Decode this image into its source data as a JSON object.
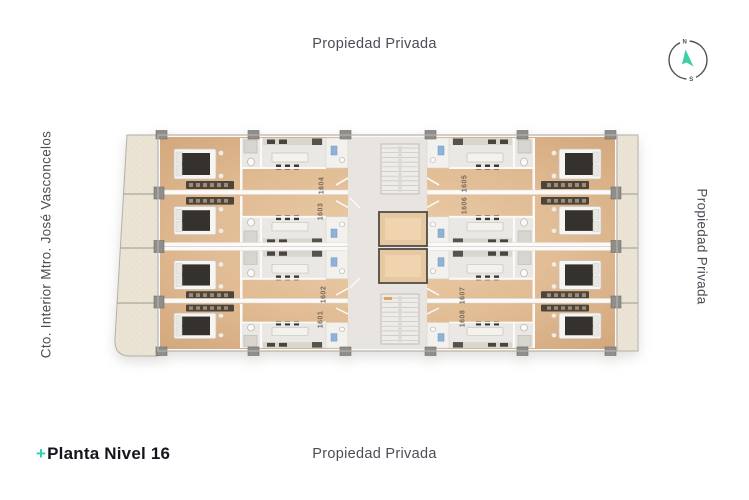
{
  "labels": {
    "top": "Propiedad Privada",
    "bottom": "Propiedad Privada",
    "right": "Propiedad Privada",
    "left": "Cto. Interior Mtro. José Vasconcelos"
  },
  "compass": {
    "north": "N",
    "south": "S",
    "needle_color": "#3ecfa5"
  },
  "footer": {
    "plus": "+",
    "title": "Planta Nivel 16",
    "accent_color": "#2fd0ad"
  },
  "plan": {
    "level": "16",
    "units": [
      {
        "label": "1601"
      },
      {
        "label": "1602"
      },
      {
        "label": "1603"
      },
      {
        "label": "1604"
      },
      {
        "label": "1605"
      },
      {
        "label": "1606"
      },
      {
        "label": "1607"
      },
      {
        "label": "1608"
      }
    ],
    "colors": {
      "wood": "#ddb48c",
      "marble": "#eae8e4",
      "stone": "#ebe4d6",
      "fixture_blue": "#8fb3d8",
      "text_gray": "#4d4d56"
    }
  }
}
